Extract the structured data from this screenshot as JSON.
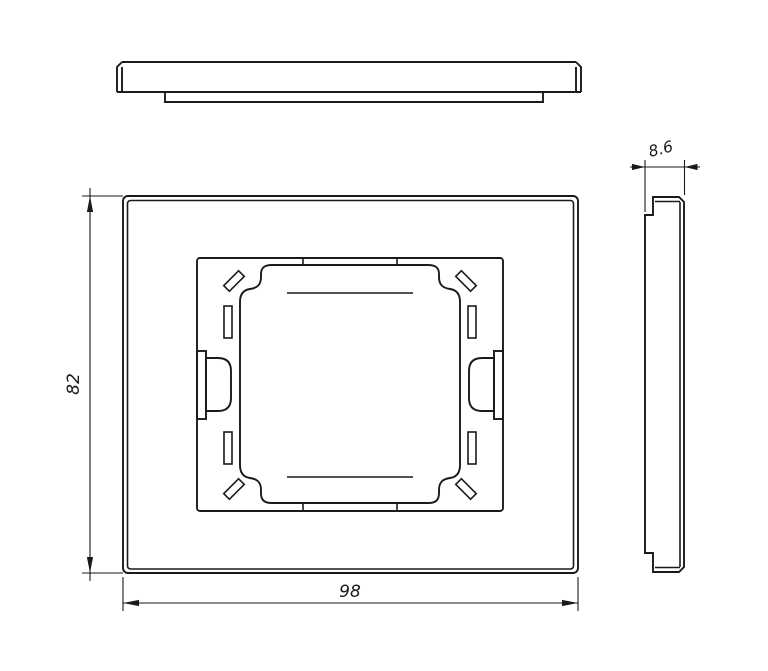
{
  "drawing": {
    "type": "technical-drawing",
    "views": {
      "top": "top profile view",
      "front": "front view with mounting frame",
      "side": "side profile view"
    },
    "dimensions": {
      "height": "82",
      "width": "98",
      "thickness": "8.6"
    },
    "colors": {
      "line": "#1a1a1a",
      "background": "#ffffff"
    }
  }
}
